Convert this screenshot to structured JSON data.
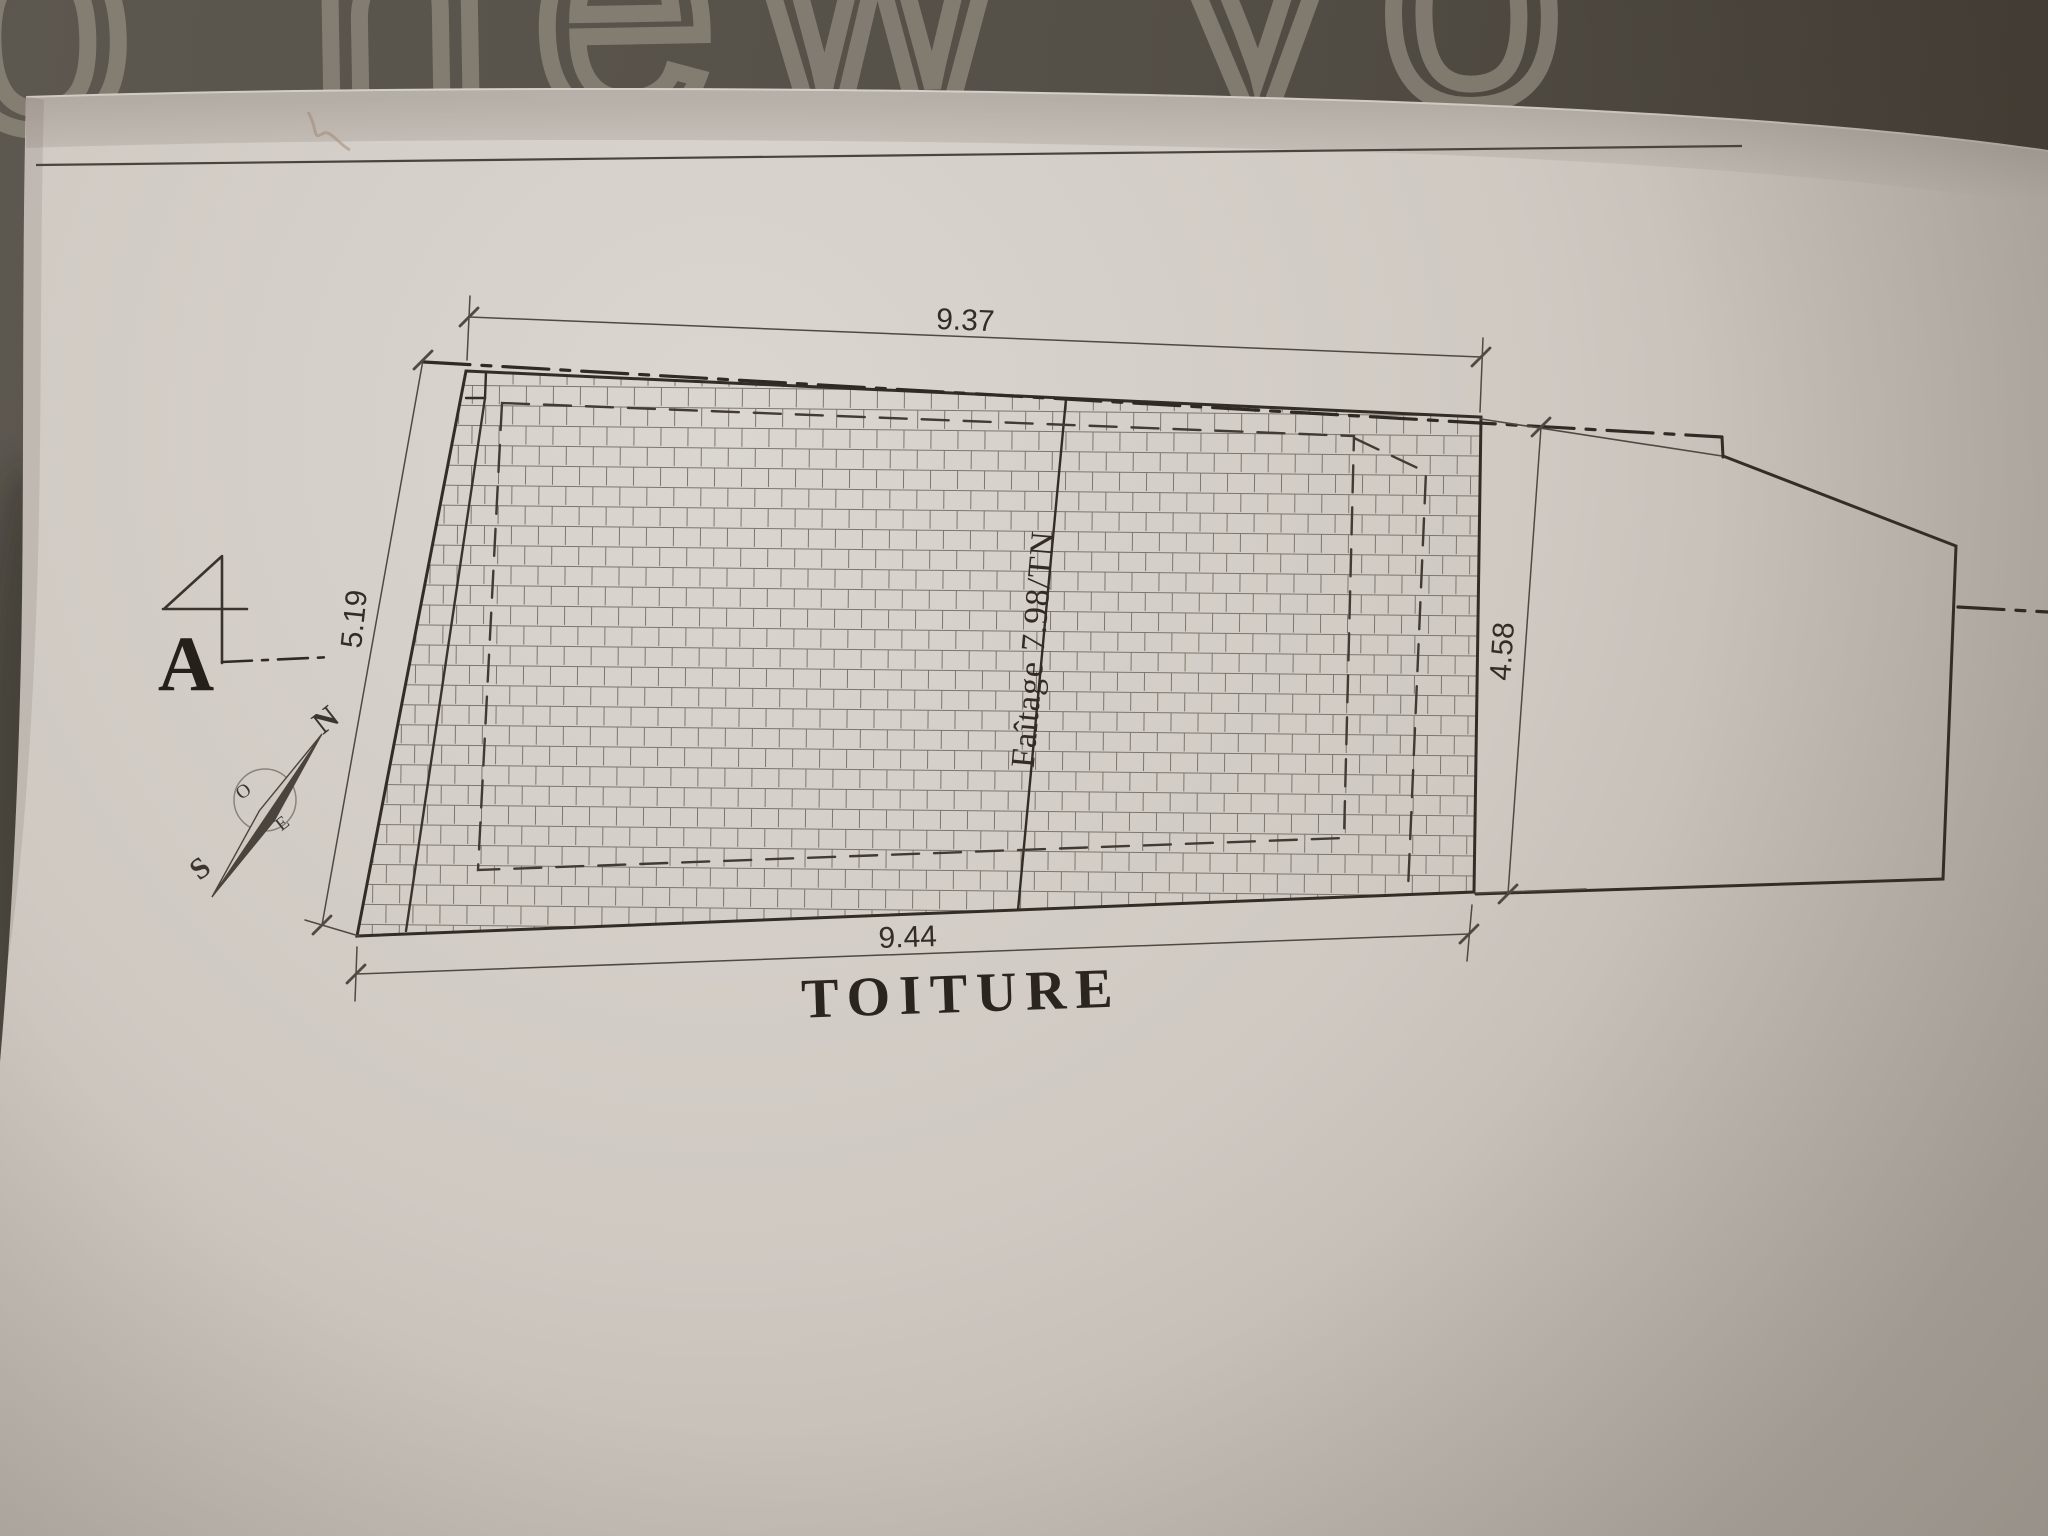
{
  "scene": {
    "fabric_text": "o new yo"
  },
  "plan": {
    "title": "TOITURE",
    "section_label": "A",
    "ridge_label": "Faîtage 7.98/TN",
    "dim_top": "9.37",
    "dim_bottom": "9.44",
    "dim_left": "5.19",
    "dim_right": "4.58",
    "compass": {
      "n": "N",
      "s": "S",
      "e": "E",
      "o": "O"
    }
  },
  "colors": {
    "fabric": "#57524a",
    "fabric_print": "#958e82",
    "paper": "#d5cfc8",
    "ink": "#332d26",
    "tile_line": "#7d766c"
  }
}
